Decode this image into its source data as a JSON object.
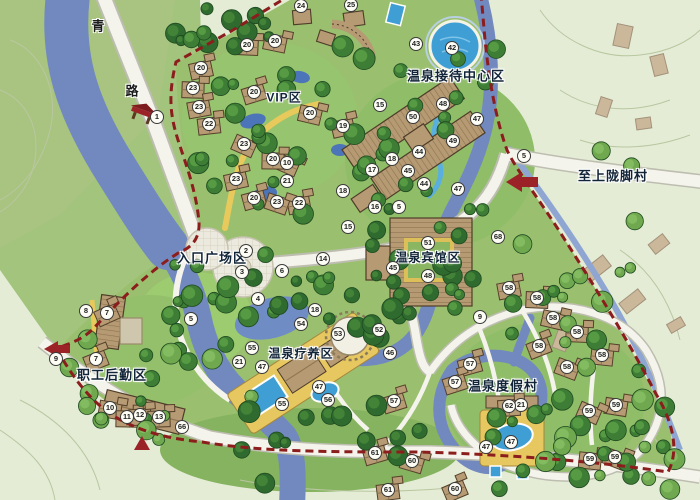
{
  "map": {
    "title": "温泉度假区总平面图",
    "area_labels": [
      {
        "id": "reception-center",
        "text": "温泉接待中心区",
        "x": 456,
        "y": 75,
        "fs": 13
      },
      {
        "id": "vip",
        "text": "VIP区",
        "x": 284,
        "y": 97,
        "fs": 12
      },
      {
        "id": "entrance-plaza",
        "text": "入口广场区",
        "x": 212,
        "y": 257,
        "fs": 13
      },
      {
        "id": "hotspring-hotel",
        "text": "温泉宾馆区",
        "x": 428,
        "y": 257,
        "fs": 12
      },
      {
        "id": "recuperation",
        "text": "温泉疗养区",
        "x": 301,
        "y": 353,
        "fs": 12
      },
      {
        "id": "resort-village",
        "text": "温泉度假村",
        "x": 503,
        "y": 385,
        "fs": 13
      },
      {
        "id": "staff-logistics",
        "text": "职工后勤区",
        "x": 112,
        "y": 374,
        "fs": 13
      },
      {
        "id": "to-village",
        "text": "至上陇脚村",
        "x": 613,
        "y": 175,
        "fs": 13
      }
    ],
    "road_label_chars": [
      {
        "text": "青",
        "x": 98,
        "y": 25
      },
      {
        "text": "路",
        "x": 132,
        "y": 90
      }
    ],
    "markers": [
      {
        "n": 1,
        "x": 157,
        "y": 117
      },
      {
        "n": 2,
        "x": 246,
        "y": 251
      },
      {
        "n": 3,
        "x": 242,
        "y": 272
      },
      {
        "n": 4,
        "x": 258,
        "y": 299
      },
      {
        "n": 5,
        "x": 191,
        "y": 319
      },
      {
        "n": 5,
        "x": 399,
        "y": 207
      },
      {
        "n": 5,
        "x": 524,
        "y": 156
      },
      {
        "n": 6,
        "x": 282,
        "y": 271
      },
      {
        "n": 7,
        "x": 107,
        "y": 313
      },
      {
        "n": 7,
        "x": 96,
        "y": 359
      },
      {
        "n": 8,
        "x": 86,
        "y": 311
      },
      {
        "n": 9,
        "x": 56,
        "y": 359
      },
      {
        "n": 9,
        "x": 480,
        "y": 317
      },
      {
        "n": 10,
        "x": 287,
        "y": 163
      },
      {
        "n": 10,
        "x": 110,
        "y": 408
      },
      {
        "n": 11,
        "x": 127,
        "y": 417
      },
      {
        "n": 12,
        "x": 140,
        "y": 415
      },
      {
        "n": 13,
        "x": 159,
        "y": 417
      },
      {
        "n": 14,
        "x": 323,
        "y": 259
      },
      {
        "n": 15,
        "x": 380,
        "y": 105
      },
      {
        "n": 15,
        "x": 348,
        "y": 227
      },
      {
        "n": 16,
        "x": 375,
        "y": 207
      },
      {
        "n": 17,
        "x": 372,
        "y": 170
      },
      {
        "n": 18,
        "x": 392,
        "y": 159
      },
      {
        "n": 18,
        "x": 343,
        "y": 191
      },
      {
        "n": 18,
        "x": 315,
        "y": 310
      },
      {
        "n": 19,
        "x": 343,
        "y": 126
      },
      {
        "n": 20,
        "x": 247,
        "y": 45
      },
      {
        "n": 20,
        "x": 275,
        "y": 41
      },
      {
        "n": 20,
        "x": 201,
        "y": 68
      },
      {
        "n": 20,
        "x": 254,
        "y": 92
      },
      {
        "n": 20,
        "x": 310,
        "y": 113
      },
      {
        "n": 20,
        "x": 273,
        "y": 159
      },
      {
        "n": 20,
        "x": 254,
        "y": 198
      },
      {
        "n": 21,
        "x": 287,
        "y": 181
      },
      {
        "n": 21,
        "x": 239,
        "y": 362
      },
      {
        "n": 21,
        "x": 521,
        "y": 405
      },
      {
        "n": 22,
        "x": 209,
        "y": 124
      },
      {
        "n": 22,
        "x": 299,
        "y": 203
      },
      {
        "n": 23,
        "x": 193,
        "y": 88
      },
      {
        "n": 23,
        "x": 199,
        "y": 107
      },
      {
        "n": 23,
        "x": 244,
        "y": 144
      },
      {
        "n": 23,
        "x": 236,
        "y": 179
      },
      {
        "n": 23,
        "x": 277,
        "y": 202
      },
      {
        "n": 24,
        "x": 301,
        "y": 6
      },
      {
        "n": 25,
        "x": 351,
        "y": 5
      },
      {
        "n": 42,
        "x": 452,
        "y": 48
      },
      {
        "n": 43,
        "x": 416,
        "y": 44
      },
      {
        "n": 44,
        "x": 419,
        "y": 152
      },
      {
        "n": 44,
        "x": 424,
        "y": 184
      },
      {
        "n": 45,
        "x": 408,
        "y": 171
      },
      {
        "n": 45,
        "x": 393,
        "y": 268
      },
      {
        "n": 46,
        "x": 390,
        "y": 353
      },
      {
        "n": 47,
        "x": 477,
        "y": 119
      },
      {
        "n": 47,
        "x": 458,
        "y": 189
      },
      {
        "n": 47,
        "x": 262,
        "y": 367
      },
      {
        "n": 47,
        "x": 319,
        "y": 387
      },
      {
        "n": 47,
        "x": 486,
        "y": 447
      },
      {
        "n": 47,
        "x": 511,
        "y": 442
      },
      {
        "n": 48,
        "x": 443,
        "y": 104
      },
      {
        "n": 48,
        "x": 428,
        "y": 276
      },
      {
        "n": 49,
        "x": 453,
        "y": 141
      },
      {
        "n": 50,
        "x": 413,
        "y": 117
      },
      {
        "n": 51,
        "x": 428,
        "y": 243
      },
      {
        "n": 52,
        "x": 379,
        "y": 330
      },
      {
        "n": 53,
        "x": 338,
        "y": 334
      },
      {
        "n": 54,
        "x": 301,
        "y": 324
      },
      {
        "n": 55,
        "x": 252,
        "y": 348
      },
      {
        "n": 55,
        "x": 282,
        "y": 404
      },
      {
        "n": 56,
        "x": 328,
        "y": 400
      },
      {
        "n": 57,
        "x": 470,
        "y": 364
      },
      {
        "n": 57,
        "x": 455,
        "y": 382
      },
      {
        "n": 57,
        "x": 394,
        "y": 401
      },
      {
        "n": 58,
        "x": 509,
        "y": 288
      },
      {
        "n": 58,
        "x": 537,
        "y": 298
      },
      {
        "n": 58,
        "x": 553,
        "y": 318
      },
      {
        "n": 58,
        "x": 539,
        "y": 346
      },
      {
        "n": 58,
        "x": 567,
        "y": 367
      },
      {
        "n": 58,
        "x": 577,
        "y": 332
      },
      {
        "n": 58,
        "x": 602,
        "y": 355
      },
      {
        "n": 59,
        "x": 616,
        "y": 405
      },
      {
        "n": 59,
        "x": 589,
        "y": 411
      },
      {
        "n": 59,
        "x": 590,
        "y": 459
      },
      {
        "n": 59,
        "x": 615,
        "y": 457
      },
      {
        "n": 60,
        "x": 412,
        "y": 461
      },
      {
        "n": 60,
        "x": 455,
        "y": 489
      },
      {
        "n": 61,
        "x": 375,
        "y": 453
      },
      {
        "n": 61,
        "x": 388,
        "y": 490
      },
      {
        "n": 62,
        "x": 509,
        "y": 406
      },
      {
        "n": 66,
        "x": 182,
        "y": 427
      },
      {
        "n": 68,
        "x": 498,
        "y": 237
      }
    ],
    "colors": {
      "survey_base": "#e4ecd6",
      "site_green": "#9ac06f",
      "lawn": "#9ccb70",
      "river": "#7289bf",
      "pool": "#3f9fd4",
      "building": "#b59a73",
      "building_outline": "#4f3d29",
      "deck_yellow": "#e7c75f",
      "path_yellow": "#e8c95c",
      "road": "#f5f4ec",
      "boundary_red": "#8c1d1d",
      "tree_dark": "#2f6a2f",
      "marker_bg": "#fdfdf6",
      "label_color": "#122438"
    }
  }
}
